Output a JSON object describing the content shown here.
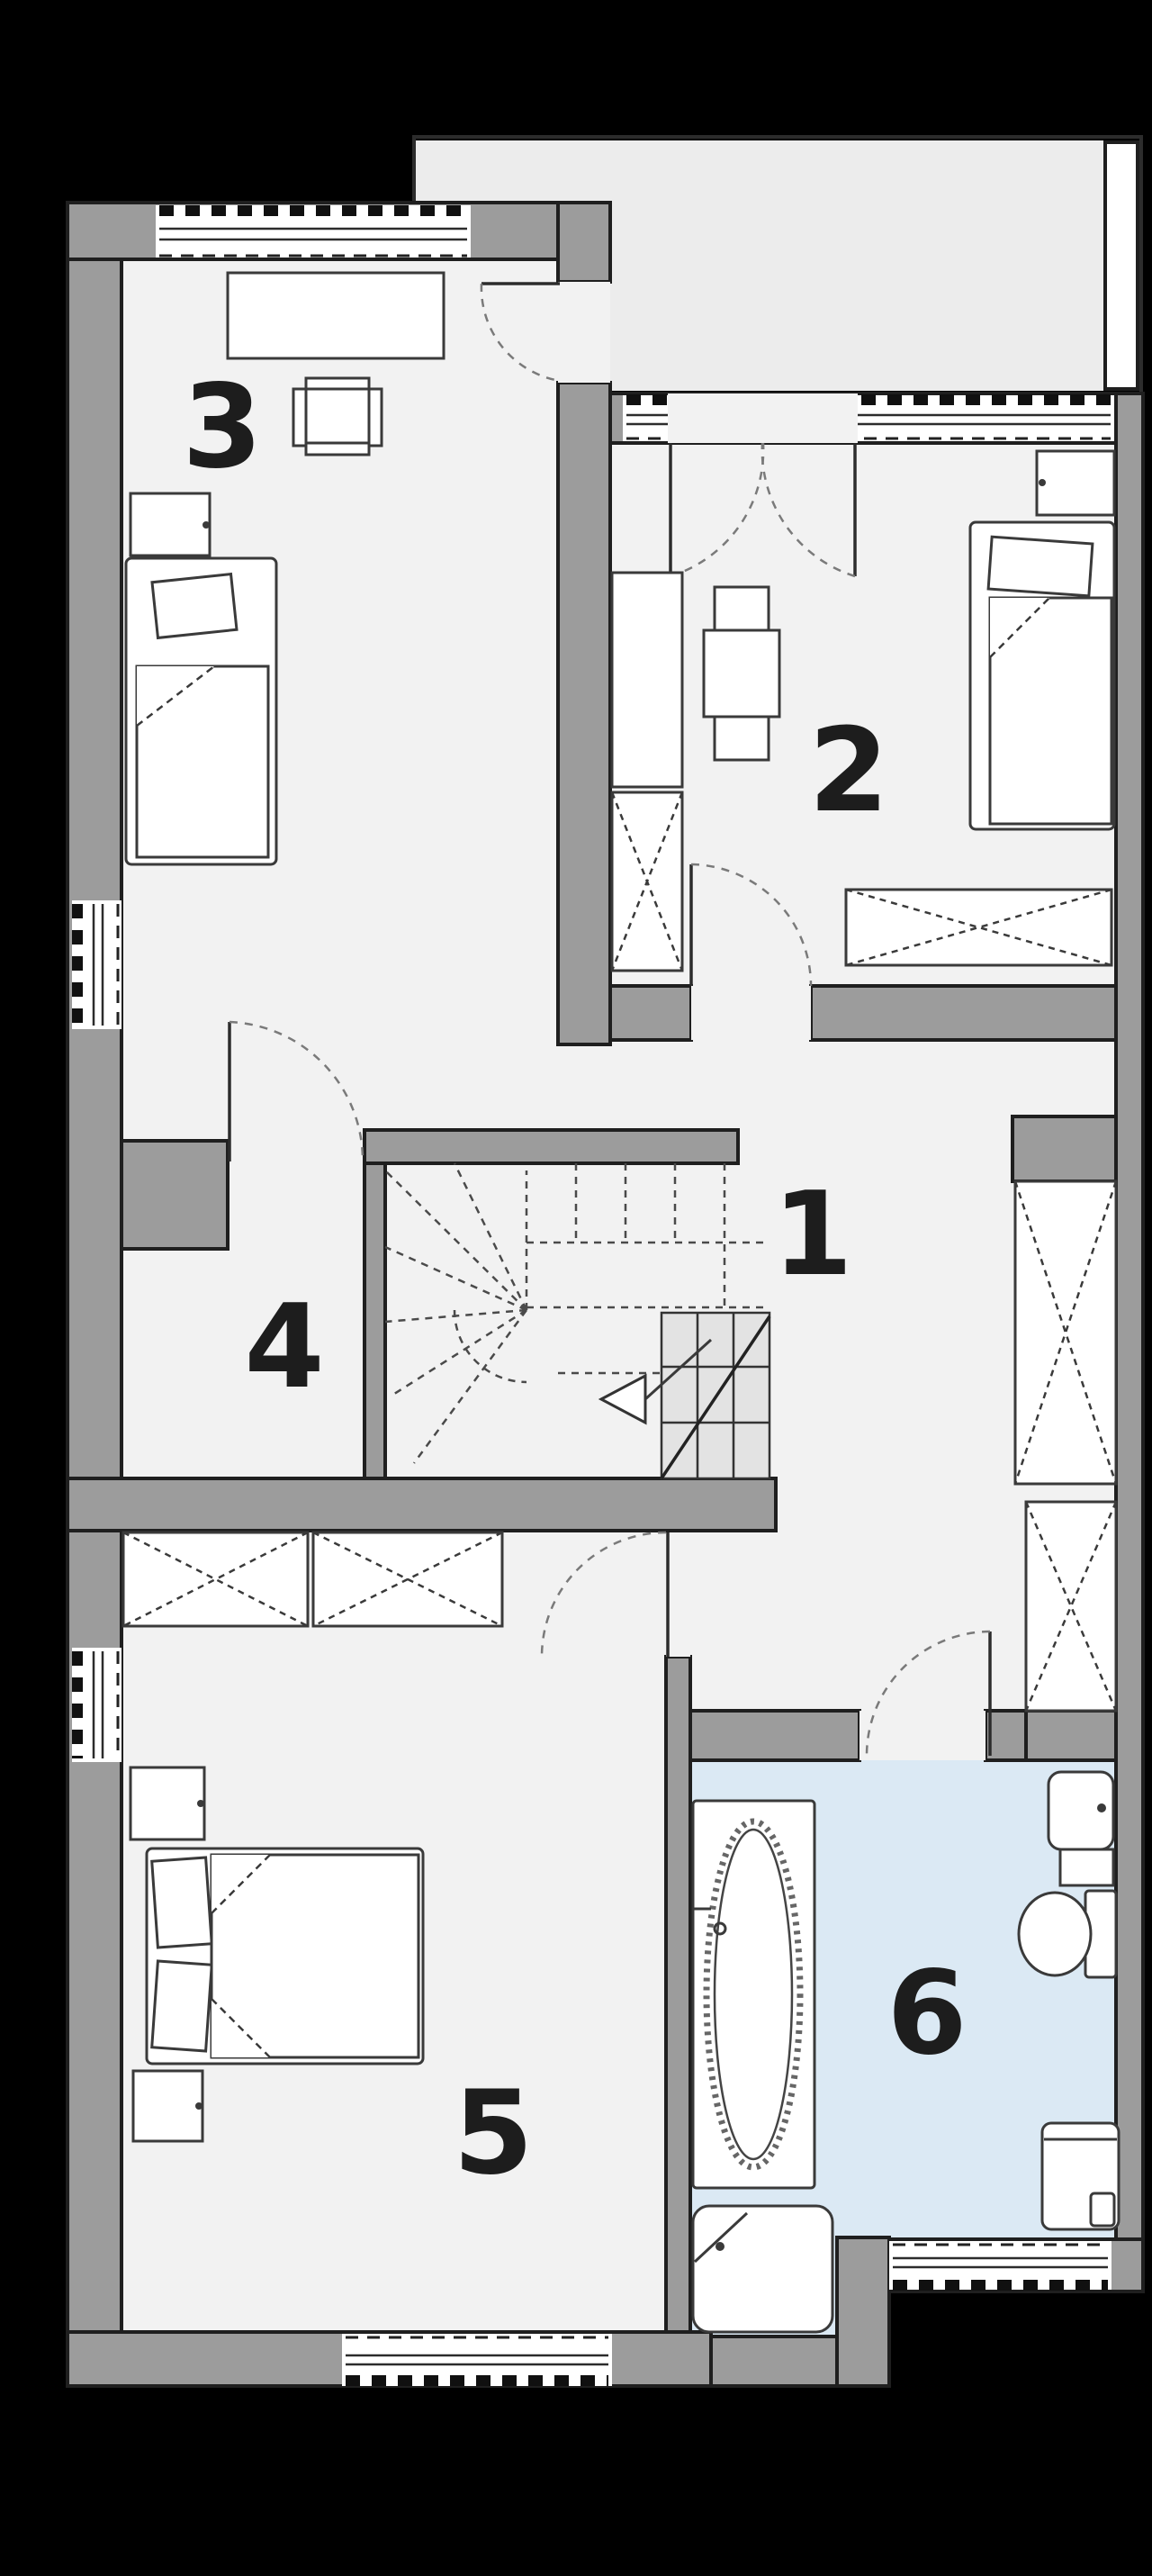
{
  "plan": {
    "kind": "architectural-floor-plan-upper-storey",
    "rooms": [
      {
        "label": "1",
        "semantic": "hall-with-stairs"
      },
      {
        "label": "2",
        "semantic": "bedroom"
      },
      {
        "label": "3",
        "semantic": "bedroom"
      },
      {
        "label": "4",
        "semantic": "closet-room"
      },
      {
        "label": "5",
        "semantic": "bedroom"
      },
      {
        "label": "6",
        "semantic": "bathroom"
      }
    ],
    "colors": {
      "background": "#000000",
      "wall": "#9c9c9c",
      "outline": "#1f1f1f",
      "floor": "#f2f2f2",
      "bath_floor": "#dbe9f4",
      "balcony_floor": "#ececec",
      "step_fill": "#e3e3e3",
      "furniture_stroke": "#3a3a3a",
      "label_color": "#1d1d1d"
    },
    "furniture_symbols": [
      "desk",
      "chair",
      "single-bed",
      "double-bed",
      "pillow",
      "nightstand",
      "wardrobe-x",
      "dresser-x",
      "table",
      "winder-stairs",
      "direction-arrow",
      "bathtub",
      "washbasin",
      "toilet",
      "washing-machine",
      "shower-tray",
      "french-door",
      "interior-door",
      "window",
      "balcony",
      "pillar"
    ]
  }
}
